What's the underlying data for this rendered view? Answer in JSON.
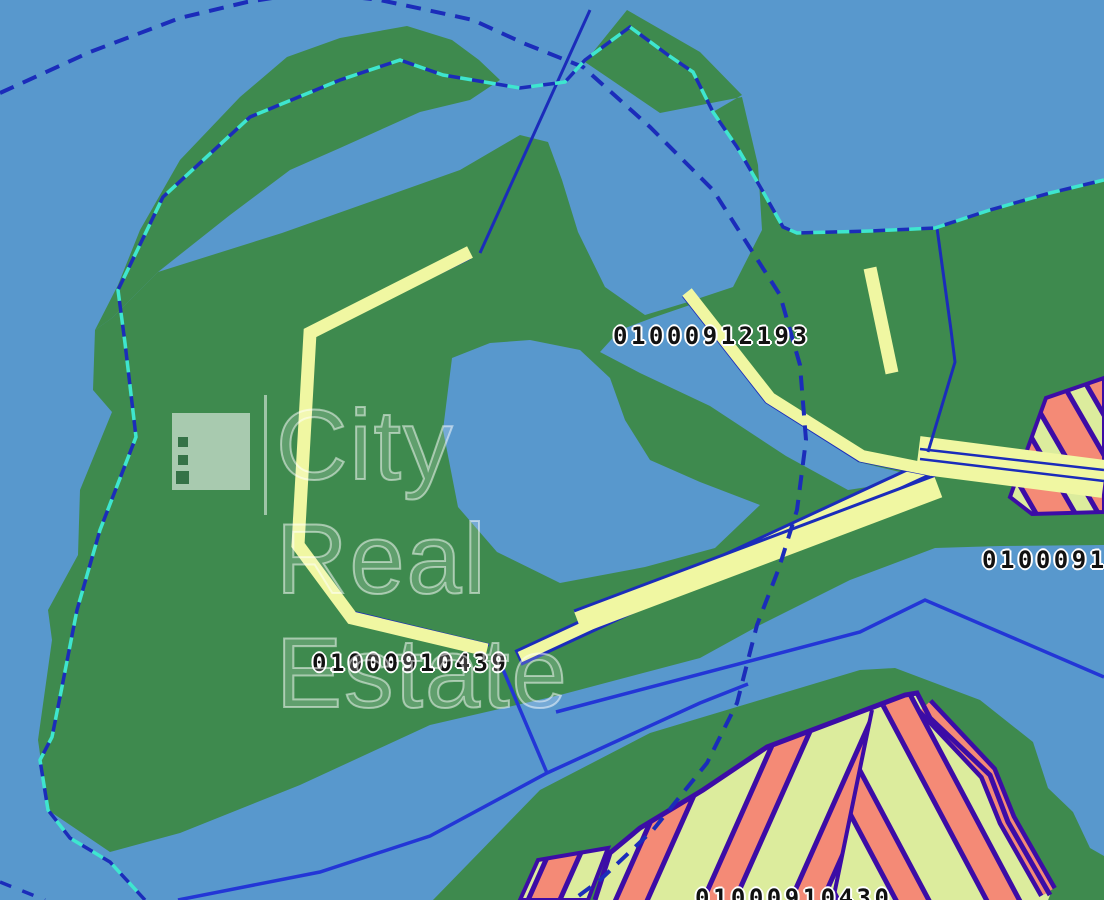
{
  "map": {
    "watermark": {
      "text": "City Real Estate",
      "logo": "city-real-estate-logo"
    },
    "parcel_labels": [
      {
        "text": "01000912193"
      },
      {
        "text": "01000910439"
      },
      {
        "text": "010009121"
      },
      {
        "text": "01000910430"
      }
    ],
    "colors": {
      "water": "#5898cd",
      "land": "#3e8a4e",
      "pier": "#f0f7a2",
      "line_navy": "#1b2cba",
      "line_blue": "#2336d6",
      "dash_cyan": "#3ee6cf",
      "parcel_lime": "#dcec9d",
      "parcel_salmon": "#f48a76",
      "parcel_border": "#3c0ca6"
    }
  }
}
